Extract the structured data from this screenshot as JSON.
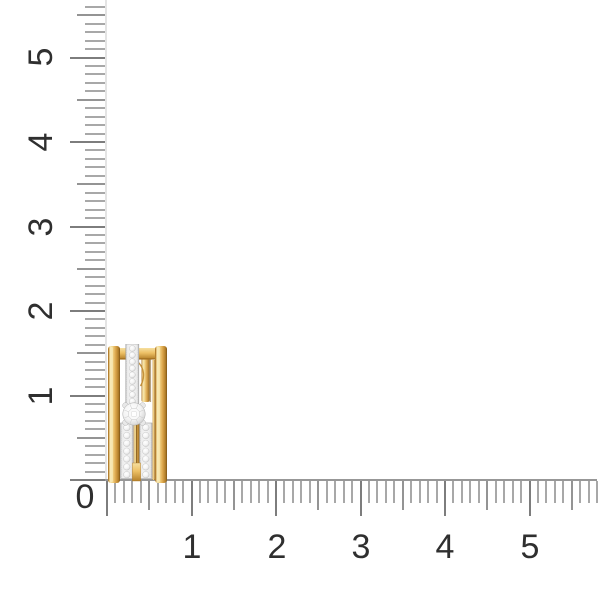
{
  "canvas": {
    "background": "#ffffff",
    "description": "Product photo of a yellow gold earring with diamonds on a white background with centimeter rulers"
  },
  "ruler": {
    "origin_label": "0",
    "vertical_labels": [
      "5",
      "4",
      "3",
      "2",
      "1"
    ],
    "horizontal_labels": [
      "1",
      "2",
      "3",
      "4",
      "5"
    ],
    "colors": {
      "minor_tick": "#a8a8a8",
      "medium_tick": "#949494",
      "major_tick": "#7d7d7d",
      "axis_line": "#979797",
      "guide_line": "#e4e4e4",
      "label": "#2f2f2f"
    }
  },
  "product": {
    "name": "yellow-gold-diamond-earring",
    "approx_width_units": 0.7,
    "approx_height_units": 1.6,
    "colors": {
      "gold_highlight": "#f6e7b2",
      "gold_mid": "#dfa94e",
      "gold_dark": "#8a5a1d",
      "diamond_white": "#f3f3f3",
      "pave_setting": "#ececec"
    }
  }
}
